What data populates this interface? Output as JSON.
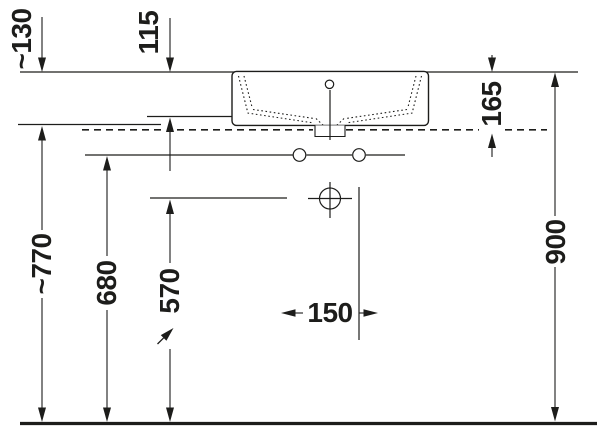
{
  "colors": {
    "ink": "#1d1d1b",
    "paper": "#ffffff"
  },
  "drawing": {
    "description": "Washbasin installation dimension drawing, front view",
    "unit": "mm",
    "labels": {
      "height_rim_to_console": "~130",
      "height_rim_to_basin_bottom": "115",
      "basin_height": "165",
      "console_height": "~770",
      "fixing_holes_height": "680",
      "drain_height": "570",
      "fixing_holes_spacing": "150",
      "rim_height": "900"
    }
  }
}
